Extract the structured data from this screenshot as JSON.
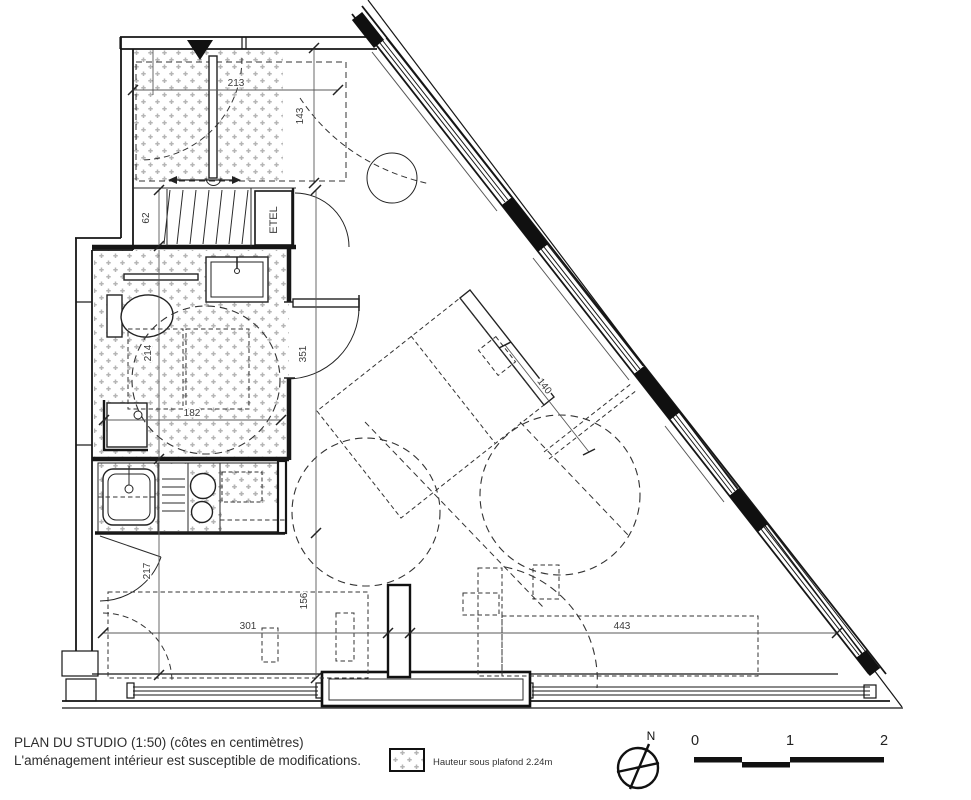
{
  "footer": {
    "title_line1": "PLAN DU STUDIO (1:50) (côtes en centimètres)",
    "title_line2": "L'aménagement intérieur est susceptible de modifications.",
    "legend_label": "Hauteur sous plafond 2.24m",
    "compass_north": "N",
    "scale_ticks": [
      "0",
      "1",
      "2"
    ]
  },
  "plan": {
    "labels": {
      "utility_closet": "ETEL"
    },
    "dimensions_cm": {
      "entry_width": "213",
      "entry_depth": "143",
      "wardrobe_depth": "62",
      "bathroom_length": "214",
      "bathroom_width": "182",
      "living_wall_upper": "351",
      "kitchen_wall": "217",
      "living_wall_lower": "156",
      "bottom_wall_left": "301",
      "bottom_wall_right": "443",
      "bed_width": "140"
    }
  },
  "colors": {
    "line": "#161616",
    "hatch": "#b5b5b5",
    "text": "#3a3a3a"
  }
}
